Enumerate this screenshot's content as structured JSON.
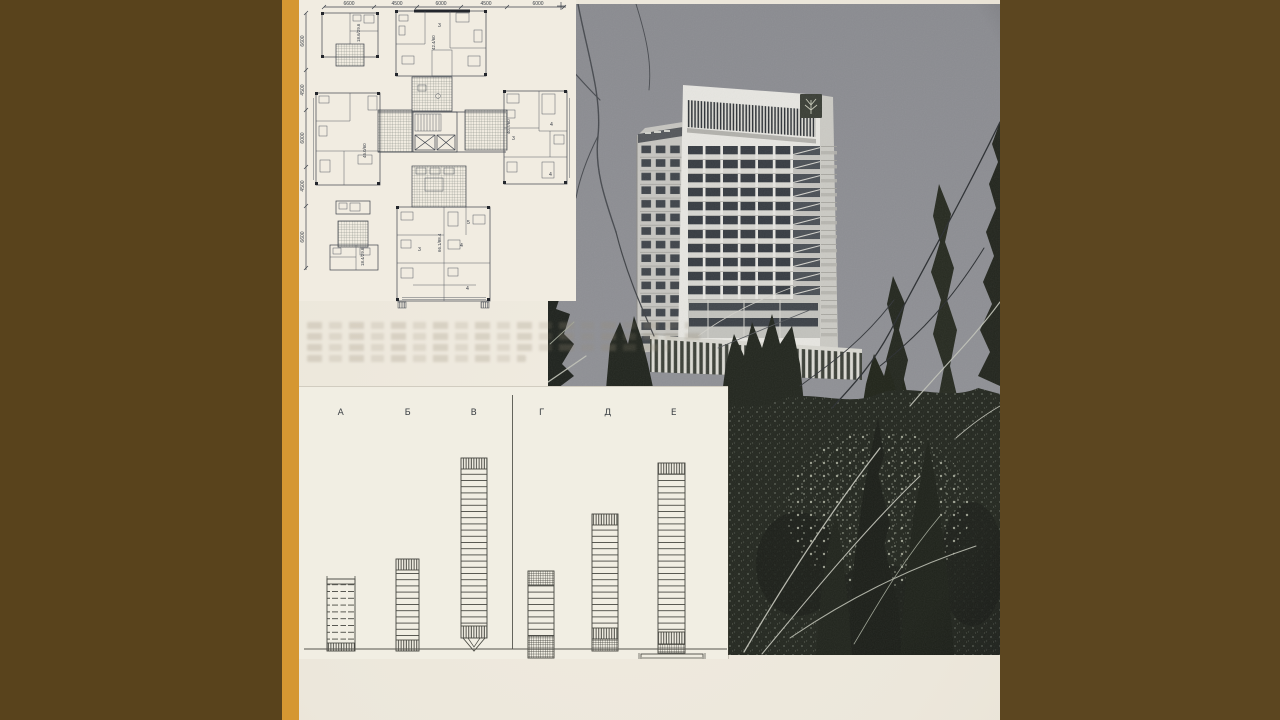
{
  "plan": {
    "dims_top": [
      "6600",
      "4500",
      "6000",
      "4500",
      "6000"
    ],
    "dims_left": [
      "6600",
      "4500",
      "6000",
      "4500",
      "6600"
    ],
    "areas": {
      "small_top": "18.6/29.6",
      "top": "42.4/60",
      "left": "45.0/60",
      "right": "40.7/60",
      "bottom": "66.1/88.4",
      "small_mid": "18.4/29.6"
    },
    "rooms": {
      "r3": "3",
      "r4": "4",
      "r5": "5"
    }
  },
  "chart": {
    "categories": [
      "А",
      "Б",
      "В",
      "Г",
      "Д",
      "Е"
    ],
    "legend": [
      "1",
      "2",
      "3"
    ]
  },
  "chart_data": {
    "type": "bar",
    "title": "",
    "xlabel": "",
    "ylabel": "",
    "grid": false,
    "categories": [
      "А",
      "Б",
      "В",
      "Г",
      "Д",
      "Е"
    ],
    "values_height_px": [
      72,
      92,
      193,
      87,
      137,
      190
    ],
    "legend_entries": [
      "1",
      "2",
      "3"
    ],
    "legend_swatches": [
      "vertical-hatch",
      "cross-hatch",
      "plain-outline"
    ],
    "divider_after_category": "В",
    "bars": [
      {
        "label": "А",
        "x": 28,
        "w": 28,
        "bottom": 264,
        "ticks": true,
        "segments": [
          {
            "t": "cap",
            "h": 5
          },
          {
            "t": "dash",
            "h": 59
          },
          {
            "t": "h1",
            "h": 8
          }
        ]
      },
      {
        "label": "Б",
        "x": 97,
        "w": 23,
        "bottom": 264,
        "segments": [
          {
            "t": "h1",
            "h": 11
          },
          {
            "t": "body",
            "h": 70
          },
          {
            "t": "h1",
            "h": 11
          }
        ]
      },
      {
        "label": "В",
        "x": 162,
        "w": 26,
        "bottom": 251,
        "funnel": 13,
        "segments": [
          {
            "t": "h1",
            "h": 11
          },
          {
            "t": "body",
            "h": 157
          },
          {
            "t": "h1",
            "h": 12
          }
        ]
      },
      {
        "label": "Г",
        "x": 229,
        "w": 26,
        "bottom": 271,
        "segments": [
          {
            "t": "h2",
            "h": 14
          },
          {
            "t": "body",
            "h": 51
          },
          {
            "t": "h2",
            "h": 22
          }
        ]
      },
      {
        "label": "Д",
        "x": 293,
        "w": 26,
        "bottom": 264,
        "segments": [
          {
            "t": "h1",
            "h": 11
          },
          {
            "t": "body",
            "h": 103
          },
          {
            "t": "h1",
            "h": 11
          },
          {
            "t": "h2",
            "h": 12
          }
        ]
      },
      {
        "label": "Е",
        "x": 359,
        "w": 27,
        "bottom": 266,
        "plinth": {
          "x": 342,
          "y": 267,
          "w": 62,
          "h": 13
        },
        "segments": [
          {
            "t": "h1",
            "h": 11
          },
          {
            "t": "body",
            "h": 158
          },
          {
            "t": "h1",
            "h": 12
          },
          {
            "t": "h2",
            "h": 9
          }
        ]
      }
    ]
  },
  "colors": {
    "border_brown": "#59431c",
    "stripe_orange": "#d59732",
    "page_cream": "#ece7db",
    "chart_paper": "#f1eee3",
    "ink": "#3d424b",
    "photo_sky": "#8e8f94",
    "building_white": "#e7e6e1",
    "tree_dark": "#1e221d"
  }
}
